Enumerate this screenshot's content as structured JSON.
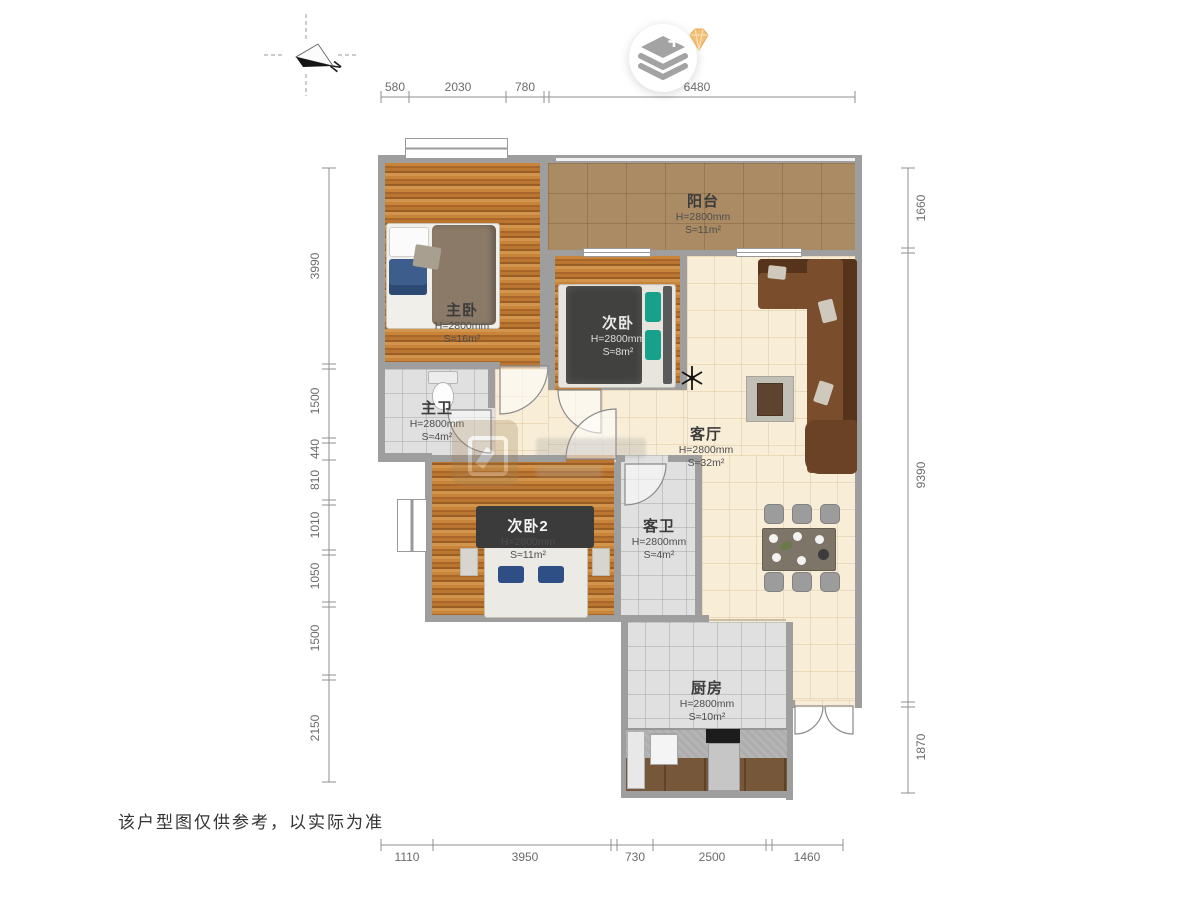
{
  "compass": {
    "north_label": "N"
  },
  "disclaimer": "该户型图仅供参考，以实际为准",
  "rooms": [
    {
      "name": "阳台",
      "height": "H=2800mm",
      "area": "S≈11m²"
    },
    {
      "name": "主卧",
      "height": "H=2800mm",
      "area": "S≈16m²"
    },
    {
      "name": "次卧",
      "height": "H=2800mm",
      "area": "S≈8m²"
    },
    {
      "name": "主卫",
      "height": "H=2800mm",
      "area": "S≈4m²"
    },
    {
      "name": "客厅",
      "height": "H=2800mm",
      "area": "S≈32m²"
    },
    {
      "name": "次卧2",
      "height": "H=2800mm",
      "area": "S≈11m²"
    },
    {
      "name": "客卫",
      "height": "H=2800mm",
      "area": "S≈4m²"
    },
    {
      "name": "厨房",
      "height": "H=2800mm",
      "area": "S≈10m²"
    }
  ],
  "dimensions": {
    "top": [
      "580",
      "2030",
      "780",
      "6480"
    ],
    "bottom": [
      "1110",
      "3950",
      "730",
      "2500",
      "1460"
    ],
    "left": [
      "3990",
      "1500",
      "440",
      "810",
      "1010",
      "1050",
      "1500",
      "2150"
    ],
    "right": [
      "1660",
      "9390",
      "1870"
    ]
  },
  "palette": {
    "wall": "#9e9e9e",
    "wood_floor": "#b9762f",
    "balcony_tile": "#ab8b64",
    "living_tile": "#f8eed8",
    "bath_tile": "#e0e0e0",
    "sofa_brown": "#74492b",
    "teal_pillow": "#17a08c",
    "blue_pillow": "#2e4f85",
    "gem_orange": "#f3c077"
  }
}
